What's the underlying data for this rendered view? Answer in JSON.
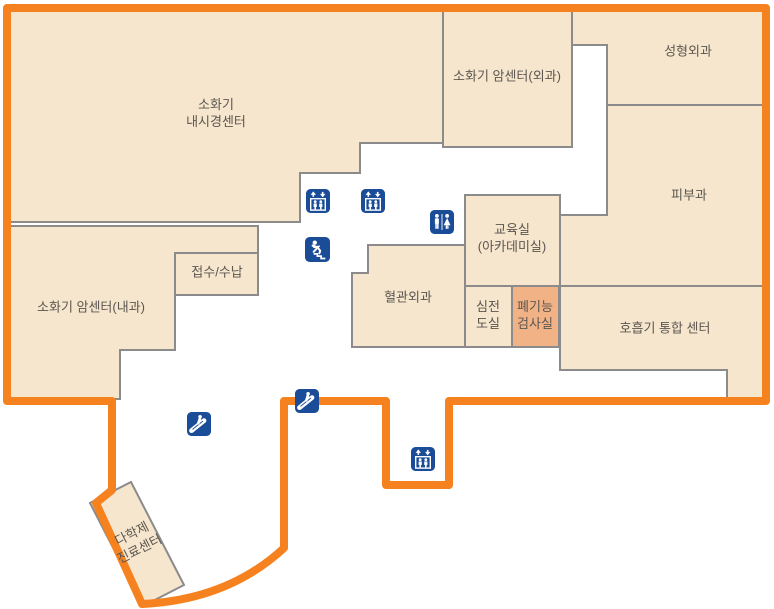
{
  "map": {
    "title": "hospital-floor-map",
    "colors": {
      "room-fill": "#F5E6CD",
      "room-border": "#8B8B8B",
      "outline-color": "#F5821F",
      "highlight-fill": "#F1B286",
      "label-color": "#5C5650",
      "icon-color": "#1B4C97"
    }
  },
  "rooms": {
    "endoscopy": {
      "label": "소화기\n내시경센터"
    },
    "cancer_surgery": {
      "label": "소화기 암센터(외과)"
    },
    "plastic_surgery": {
      "label": "성형외과"
    },
    "dermatology": {
      "label": "피부과"
    },
    "cancer_internal": {
      "label": "소화기 암센터(내과)"
    },
    "reception": {
      "label": "접수/수납"
    },
    "vascular": {
      "label": "혈관외과"
    },
    "education": {
      "label": "교육실\n(아카데미실)"
    },
    "ecg": {
      "label": "심전\n도실"
    },
    "pulmonary": {
      "label": "폐기능\n검사실",
      "highlighted": true
    },
    "respiratory": {
      "label": "호흡기 통합 센터"
    },
    "multidisciplinary": {
      "label": "다학제\n진료센터"
    }
  },
  "icons": [
    {
      "name": "elevator-icon",
      "count": 3
    },
    {
      "name": "stairs-icon",
      "count": 1
    },
    {
      "name": "restroom-icon",
      "count": 1
    },
    {
      "name": "escalator-icon",
      "count": 2
    }
  ]
}
